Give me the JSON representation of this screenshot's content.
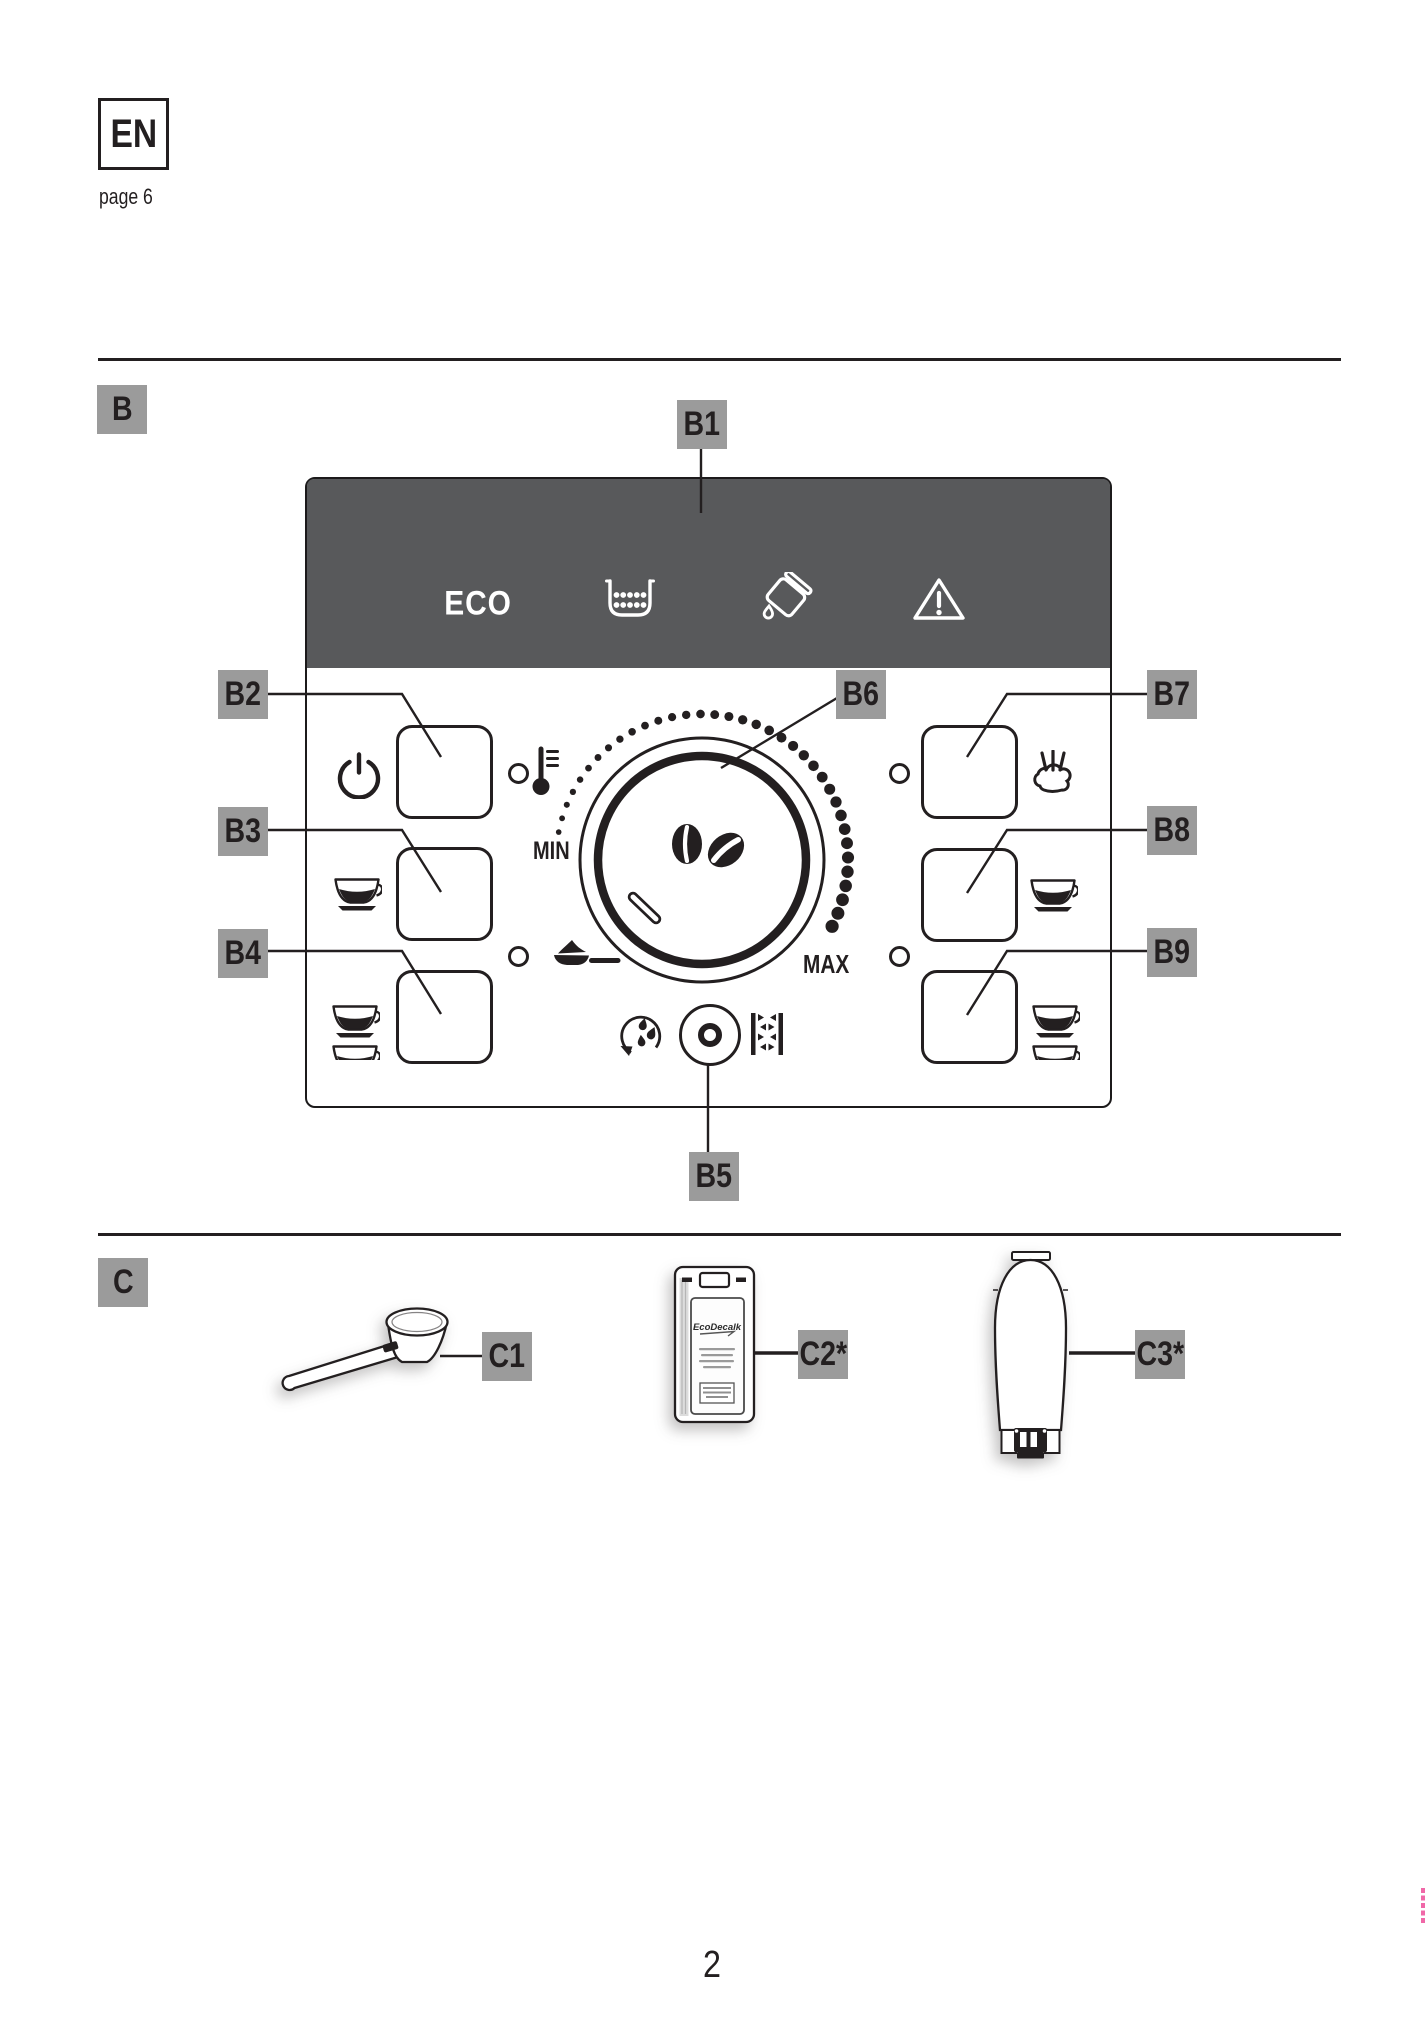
{
  "page": {
    "language_badge": "EN",
    "page_reference": "page 6",
    "page_number": "2"
  },
  "section_b": {
    "label": "B",
    "callouts": {
      "b1": "B1",
      "b2": "B2",
      "b3": "B3",
      "b4": "B4",
      "b5": "B5",
      "b6": "B6",
      "b7": "B7",
      "b8": "B8",
      "b9": "B9"
    },
    "display": {
      "eco_label": "ECO",
      "indicator_icons": [
        "grounds-container",
        "refill-water",
        "warning"
      ]
    },
    "dial": {
      "min_label": "MIN",
      "max_label": "MAX",
      "center_icon": "coffee-beans"
    },
    "button_icons": {
      "b2": "power",
      "b3": "one-cup",
      "b4": "two-cups",
      "b7": "steam",
      "b8": "one-cup",
      "b9": "two-cups",
      "aux_left_top": "temperature",
      "aux_left_bottom": "pre-ground-coffee",
      "aux_bottom_left": "rinse",
      "aux_bottom_right": "descale"
    }
  },
  "section_c": {
    "label": "C",
    "callouts": {
      "c1": "C1",
      "c2": "C2*",
      "c3": "C3*"
    },
    "accessories": {
      "c1": "measuring-scoop",
      "c2": "descaler-pack",
      "c3": "water-softener-filter"
    },
    "descaler_brand": "EcoDecalk"
  },
  "colors": {
    "display_background": "#58595b",
    "callout_background": "#9b9b9b",
    "ink": "#231f20",
    "registration_mark": "#f068a8"
  }
}
